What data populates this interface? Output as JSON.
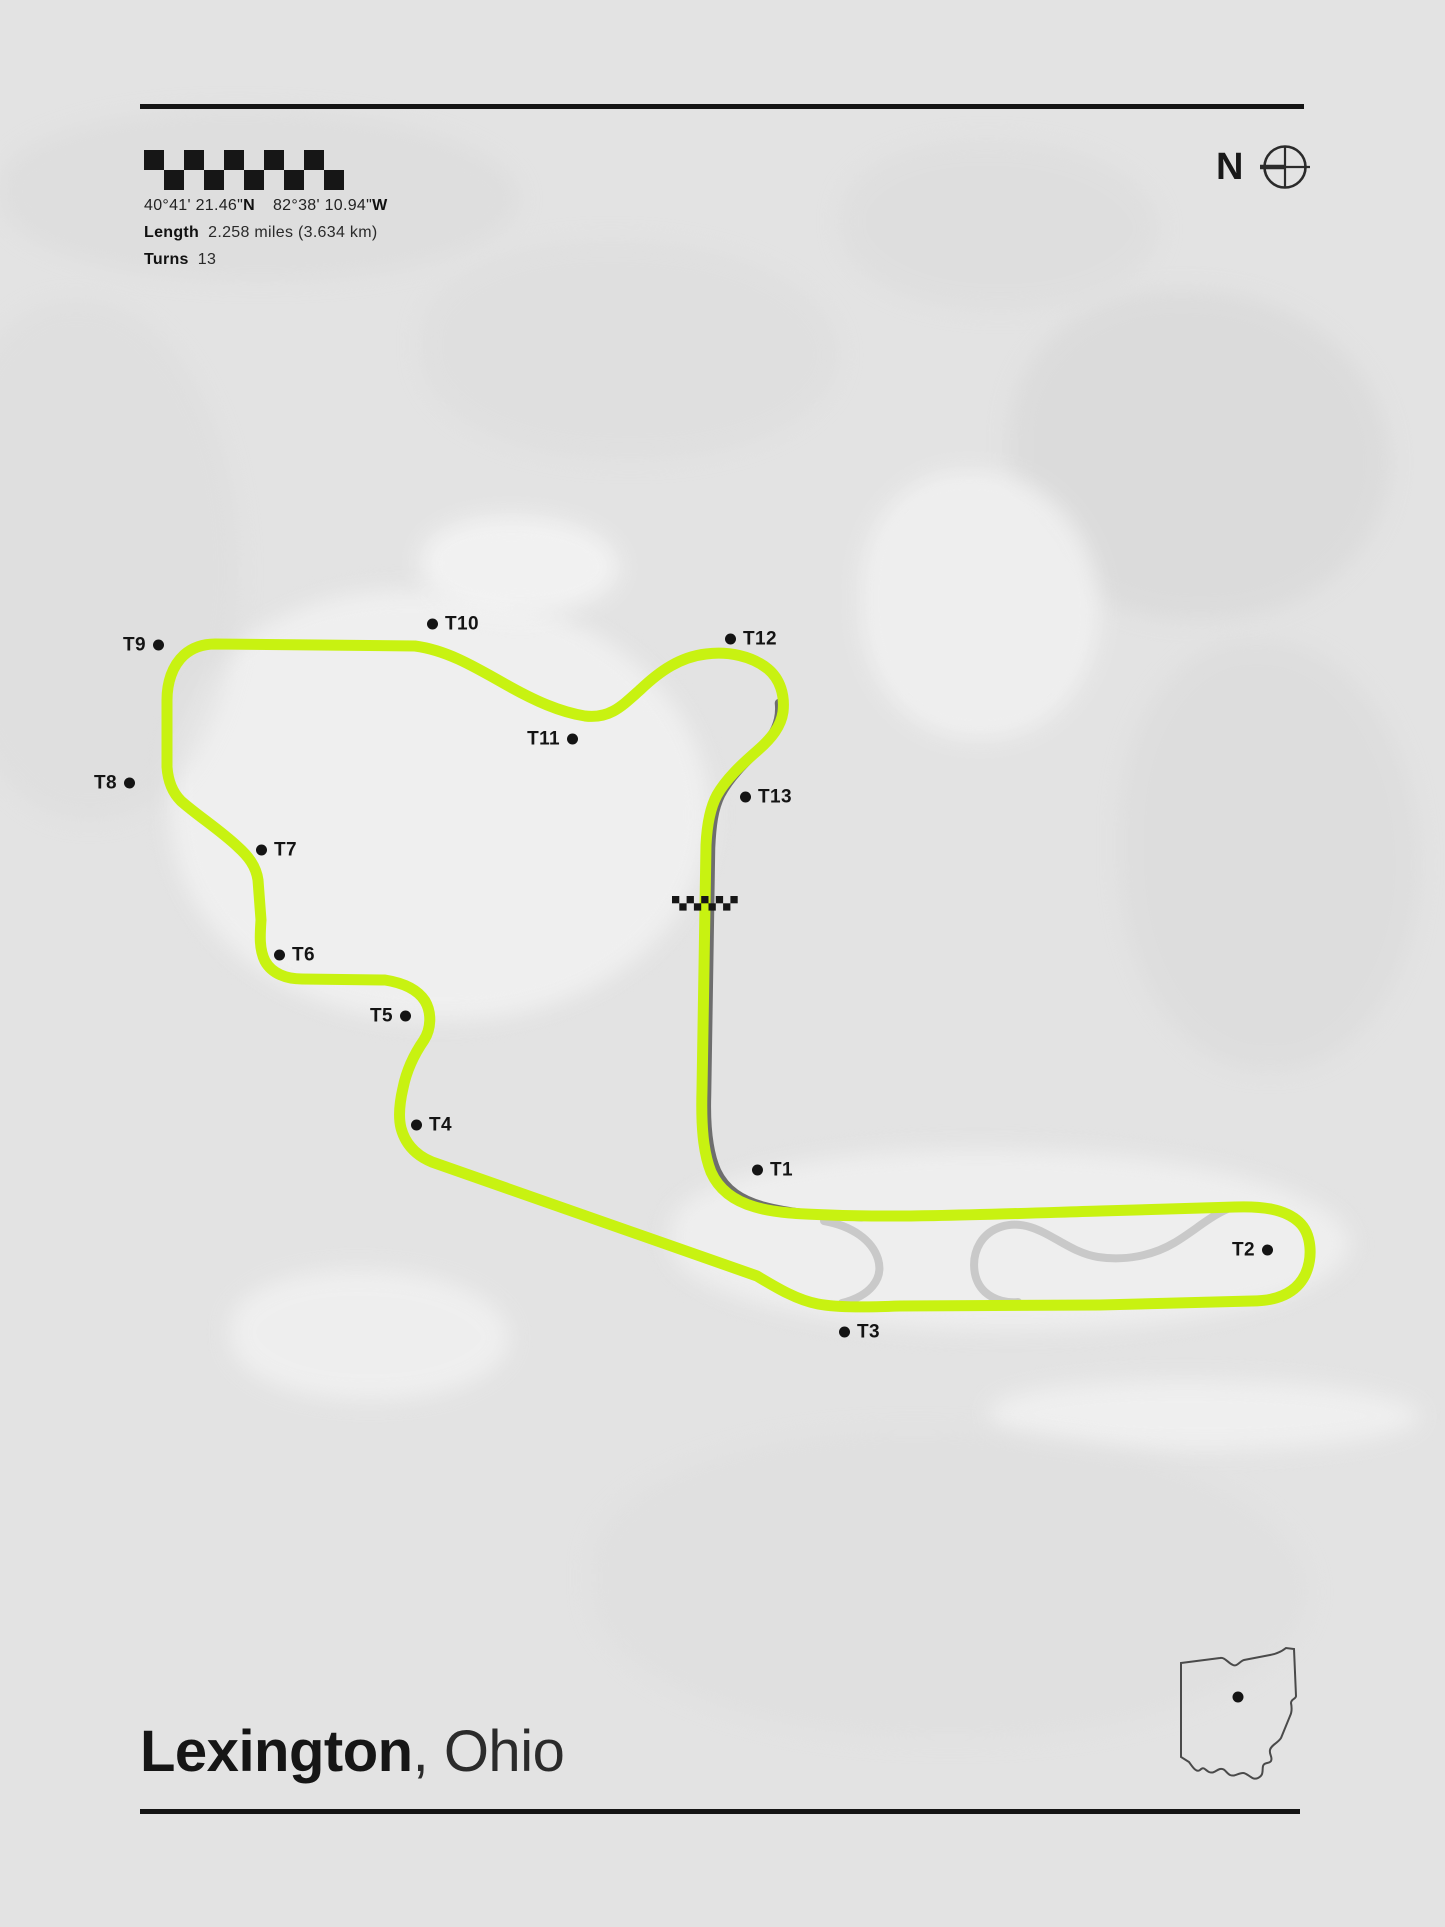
{
  "header": {
    "flag_icon": "checkered-flag",
    "coordinates": {
      "lat": "40°41' 21.46\"",
      "lat_dir": "N",
      "lon": "82°38' 10.94\"",
      "lon_dir": "W"
    },
    "length_label": "Length",
    "length_value": "2.258 miles (3.634 km)",
    "turns_label": "Turns",
    "turns_value": "13",
    "compass_letter": "N"
  },
  "map": {
    "colors": {
      "main_track": "#c8f211",
      "sector_dark": "#6e6e6e",
      "alt_track": "#c9c9c9",
      "marker": "#141414"
    },
    "start_finish_icon": "start-finish-checkers",
    "turns": [
      {
        "label": "T1",
        "x": 758,
        "y": 1170,
        "side": "right"
      },
      {
        "label": "T2",
        "x": 1267,
        "y": 1250,
        "side": "left"
      },
      {
        "label": "T3",
        "x": 845,
        "y": 1332,
        "side": "right"
      },
      {
        "label": "T4",
        "x": 417,
        "y": 1125,
        "side": "right"
      },
      {
        "label": "T5",
        "x": 405,
        "y": 1016,
        "side": "left"
      },
      {
        "label": "T6",
        "x": 280,
        "y": 955,
        "side": "right"
      },
      {
        "label": "T7",
        "x": 262,
        "y": 850,
        "side": "right"
      },
      {
        "label": "T8",
        "x": 129,
        "y": 783,
        "side": "left"
      },
      {
        "label": "T9",
        "x": 158,
        "y": 645,
        "side": "left"
      },
      {
        "label": "T10",
        "x": 433,
        "y": 624,
        "side": "right"
      },
      {
        "label": "T11",
        "x": 572,
        "y": 739,
        "side": "left"
      },
      {
        "label": "T12",
        "x": 731,
        "y": 639,
        "side": "right"
      },
      {
        "label": "T13",
        "x": 746,
        "y": 797,
        "side": "right"
      }
    ]
  },
  "footer": {
    "city": "Lexington",
    "region": ", Ohio",
    "state_icon": "ohio-state-outline"
  }
}
